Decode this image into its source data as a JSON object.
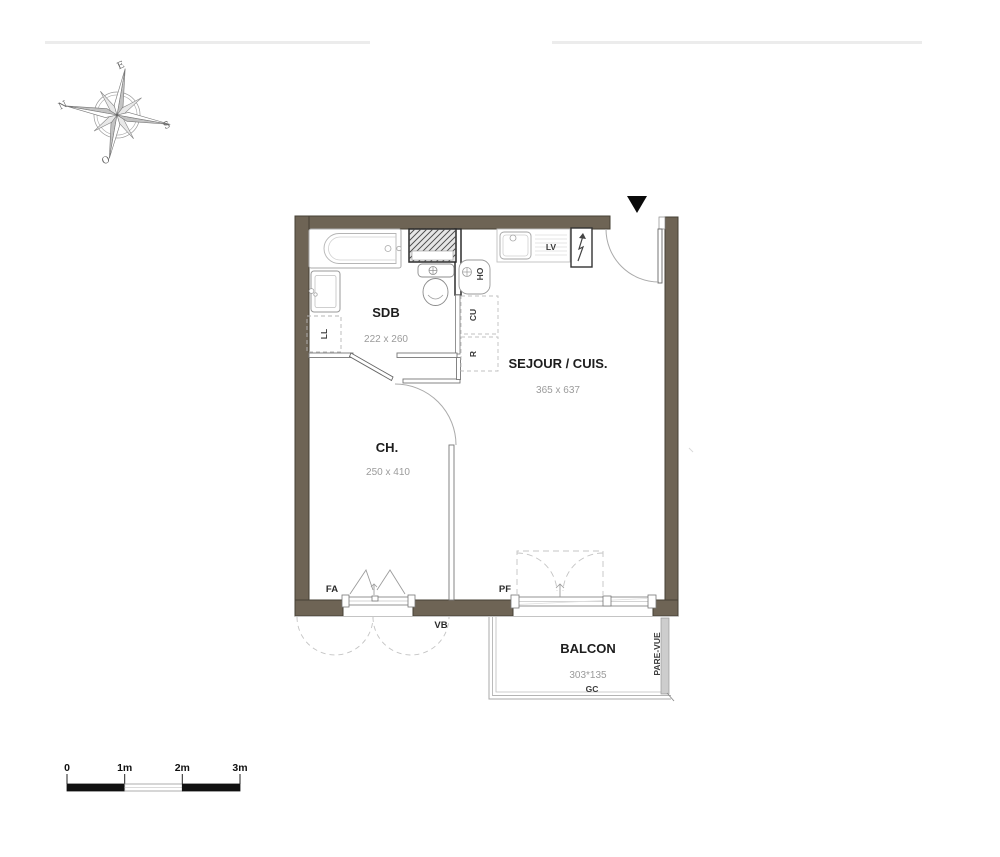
{
  "compass": {
    "east": "E",
    "north": "N",
    "south": "S",
    "west": "O"
  },
  "rooms": [
    {
      "id": "sdb",
      "name": "SDB",
      "dimensions": "222 x 260"
    },
    {
      "id": "sejour",
      "name": "SEJOUR / CUIS.",
      "dimensions": "365 x 637"
    },
    {
      "id": "chambre",
      "name": "CH.",
      "dimensions": "250 x 410"
    },
    {
      "id": "balcon",
      "name": "BALCON",
      "dimensions": "303*135"
    }
  ],
  "annotations": {
    "ll": "LL",
    "cu": "CU",
    "r": "R",
    "ho": "HO",
    "lv": "LV",
    "fa": "FA",
    "vb": "VB",
    "pf": "PF",
    "gc": "GC",
    "pare_vue": "PARE-VUE"
  },
  "scale_bar": {
    "labels": [
      "0",
      "1m",
      "2m",
      "3m"
    ]
  },
  "colors": {
    "wall": "#6e6455",
    "screen": "#cdcdcd"
  }
}
